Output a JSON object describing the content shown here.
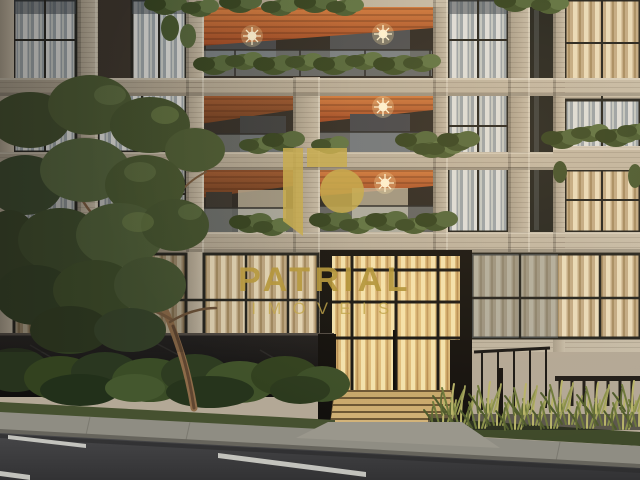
{
  "watermark": {
    "brand": "PATRIAL",
    "subtitle": "IMÓVEIS",
    "logo_color": "#C9AD50",
    "brand_text_color": "#B6983E",
    "subtitle_text_color": "#C2A64B"
  },
  "palette": {
    "stone_facade": "#B8AD99",
    "wood_soffit": "#BA5E2F",
    "window_glass": "#97A1A8",
    "curtain_cool": "#DDDEDB",
    "curtain_gold": "#ECD9A8",
    "foliage": "#4E6238",
    "dark_wall": "#1B1917",
    "asphalt": "#3D3D3F",
    "sidewalk": "#8F8D83",
    "lane_marking": "#D6D6CF"
  }
}
